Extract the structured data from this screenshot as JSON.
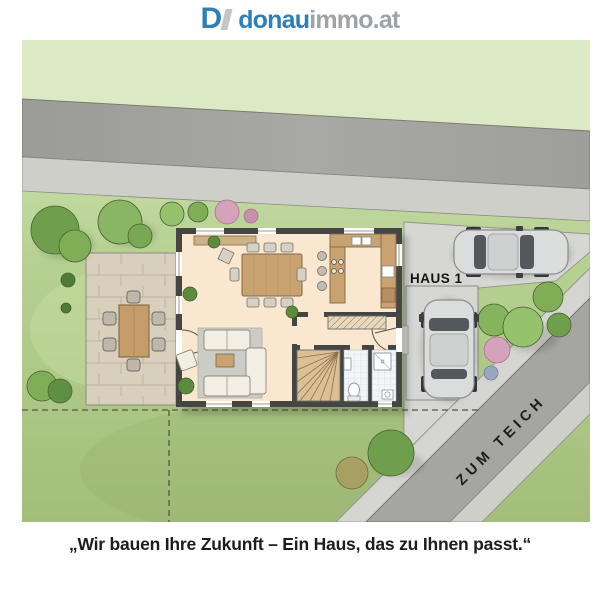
{
  "logo": {
    "mark": "D",
    "name_primary": "donau",
    "name_secondary": "immo.at"
  },
  "site_plan": {
    "house_label": "HAUS 1",
    "street_label": "ZUM TEICH"
  },
  "quote": {
    "text": "„Wir bauen Ihre Zukunft – Ein Haus, das zu Ihnen passt.“"
  },
  "colors": {
    "logo_blue": "#2b80ba",
    "logo_gray": "#9fa3a6",
    "lawn_top": "#d8e7bf",
    "lawn_mid": "#b7d192",
    "lawn_bottom": "#a3bd7a",
    "upper_lawn": "#dbe9c4",
    "road": "#a2a29e",
    "sidewalk": "#cfcfca",
    "driveway": "#d6d6d2",
    "terrace": "#d9cfbd",
    "house_wall": "#454543",
    "house_floor": "#f9e7d0",
    "wood": "#c8a271",
    "rug": "#ccccc6",
    "tile": "#f3f6f8",
    "car_body": "#dbdcdc",
    "label_text": "#141414"
  }
}
